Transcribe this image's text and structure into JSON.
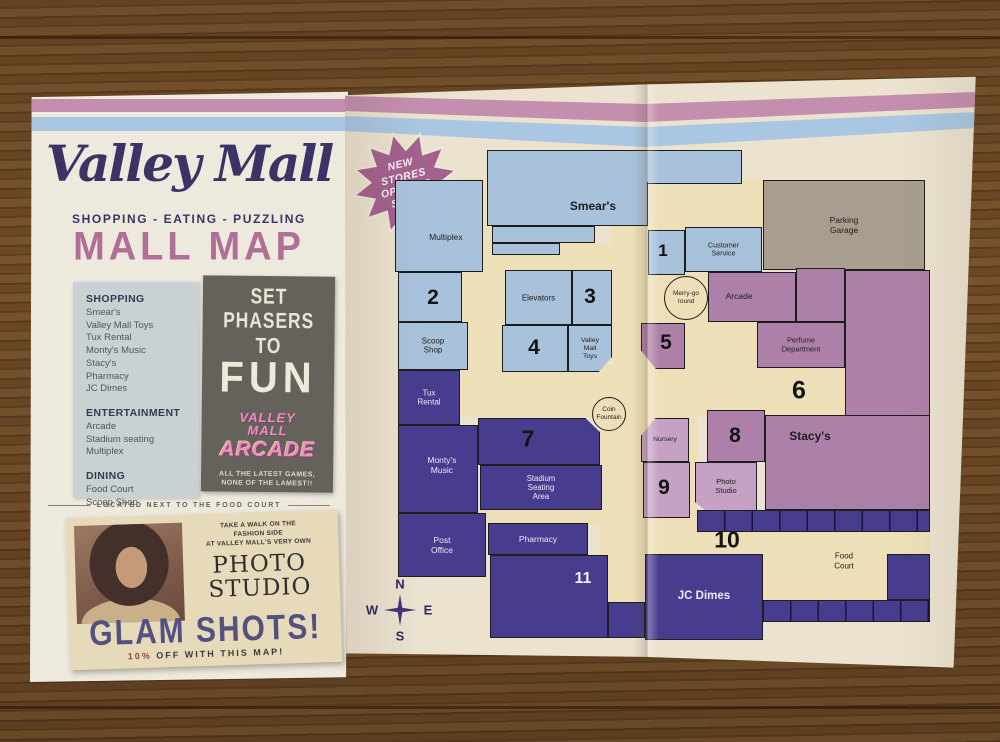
{
  "cover": {
    "logo": "Valley Mall",
    "tagline": "SHOPPING - EATING - PUZZLING",
    "title": "MALL MAP",
    "directory": [
      {
        "heading": "SHOPPING",
        "items": [
          "Smear's",
          "Valley Mall Toys",
          "Tux Rental",
          "Monty's Music",
          "Stacy's",
          "Pharmacy",
          "JC Dimes"
        ]
      },
      {
        "heading": "ENTERTAINMENT",
        "items": [
          "Arcade",
          "Stadium seating",
          "Multiplex"
        ]
      },
      {
        "heading": "DINING",
        "items": [
          "Food Court",
          "Scoop Shop"
        ]
      }
    ],
    "arcade_ad": {
      "headline": "SET\nPHASERS\nTO",
      "big_word": "FUN",
      "logo_top": "VALLEY\nMALL",
      "logo_main": "ARCADE",
      "tagline": "ALL THE LATEST GAMES,\nNONE OF THE LAMEST!!"
    },
    "kicker": "LOCATED NEXT TO THE FOOD COURT",
    "photo_ad": {
      "lead": "TAKE A WALK ON THE\nFASHION SIDE\nAT VALLEY MALL'S VERY OWN",
      "title": "PHOTO\nSTUDIO",
      "headline": "GLAM SHOTS!",
      "offer_prefix": "10%",
      "offer_rest": " OFF WITH THIS MAP!"
    }
  },
  "map": {
    "badge": "NEW\nSTORES\nOPENING\nSOON!",
    "compass": {
      "n": "N",
      "s": "S",
      "e": "E",
      "w": "W"
    },
    "halls": [
      {
        "id": "hall-west",
        "x": 110,
        "y": 90,
        "w": 45,
        "h": 196
      },
      {
        "id": "hall-smears-south",
        "x": 142,
        "y": 155,
        "w": 120,
        "h": 27
      },
      {
        "id": "hall-central",
        "x": 105,
        "y": 277,
        "w": 395,
        "h": 52
      },
      {
        "id": "hall-carousel",
        "x": 262,
        "y": 124,
        "w": 100,
        "h": 160
      },
      {
        "id": "hall-northeast",
        "x": 300,
        "y": 92,
        "w": 115,
        "h": 47
      },
      {
        "id": "hall-southeast",
        "x": 250,
        "y": 327,
        "w": 97,
        "h": 192
      },
      {
        "id": "hall-ten",
        "x": 252,
        "y": 444,
        "w": 328,
        "h": 26
      },
      {
        "id": "hall-food-court",
        "x": 413,
        "y": 466,
        "w": 124,
        "h": 46
      },
      {
        "id": "hall-stadium-south",
        "x": 130,
        "y": 420,
        "w": 122,
        "h": 17
      },
      {
        "id": "hall-perfume-west",
        "x": 335,
        "y": 232,
        "w": 75,
        "h": 50
      }
    ],
    "rooms": [
      {
        "id": "multiplex",
        "c": "blue",
        "x": 45,
        "y": 92,
        "w": 88,
        "h": 92,
        "l": "Multiplex",
        "fs": 8.5,
        "lp": [
          58,
          62
        ]
      },
      {
        "id": "room-2",
        "c": "blue",
        "x": 48,
        "y": 184,
        "w": 64,
        "h": 50
      },
      {
        "id": "scoop-shop",
        "c": "blue",
        "x": 48,
        "y": 234,
        "w": 70,
        "h": 48,
        "l": "Scoop\nShop",
        "fs": 8
      },
      {
        "id": "smears-upper",
        "c": "blue",
        "x": 137,
        "y": 62,
        "w": 255,
        "h": 34
      },
      {
        "id": "smears",
        "c": "blue",
        "x": 137,
        "y": 94,
        "w": 161,
        "h": 44,
        "l": "Smear's",
        "b": 1,
        "fs": 12,
        "lp": [
          66,
          55
        ],
        "noTop": 1
      },
      {
        "id": "smears-annex-a",
        "c": "blue",
        "x": 142,
        "y": 138,
        "w": 103,
        "h": 17
      },
      {
        "id": "smears-annex-b",
        "c": "blue",
        "x": 142,
        "y": 155,
        "w": 68,
        "h": 12
      },
      {
        "id": "elevators",
        "c": "blue",
        "x": 155,
        "y": 182,
        "w": 67,
        "h": 55,
        "l": "Elevators",
        "fs": 8
      },
      {
        "id": "room-3",
        "c": "blue",
        "x": 222,
        "y": 182,
        "w": 40,
        "h": 55
      },
      {
        "id": "room-4",
        "c": "blue",
        "x": 152,
        "y": 237,
        "w": 66,
        "h": 47
      },
      {
        "id": "valley-mall-toys",
        "c": "blue",
        "x": 218,
        "y": 237,
        "w": 44,
        "h": 47,
        "l": "Valley\nMall\nToys",
        "fs": 6.8,
        "clip": "br"
      },
      {
        "id": "room-1",
        "c": "blue",
        "x": 298,
        "y": 142,
        "w": 37,
        "h": 45
      },
      {
        "id": "customer-service",
        "c": "blue",
        "x": 335,
        "y": 139,
        "w": 77,
        "h": 45,
        "l": "Customer\nService",
        "fs": 7.2
      },
      {
        "id": "parking-garage",
        "c": "gray",
        "x": 413,
        "y": 92,
        "w": 162,
        "h": 90,
        "l": "Parking\nGarage",
        "fs": 8.5
      },
      {
        "id": "arcade",
        "c": "mauve",
        "x": 358,
        "y": 184,
        "w": 88,
        "h": 50,
        "l": "Arcade",
        "fs": 8.5,
        "lp": [
          35,
          48
        ]
      },
      {
        "id": "arcade-annex",
        "c": "mauve",
        "x": 446,
        "y": 180,
        "w": 49,
        "h": 54
      },
      {
        "id": "perfume-department",
        "c": "mauve",
        "x": 407,
        "y": 234,
        "w": 88,
        "h": 46,
        "l": "Perfume\nDepartment",
        "fs": 7.4
      },
      {
        "id": "room-5",
        "c": "mauve",
        "x": 291,
        "y": 235,
        "w": 44,
        "h": 46,
        "clip": "bl"
      },
      {
        "id": "stacys-main",
        "c": "mauve",
        "x": 495,
        "y": 182,
        "w": 85,
        "h": 240
      },
      {
        "id": "stacys",
        "c": "mauve",
        "x": 415,
        "y": 327,
        "w": 165,
        "h": 95,
        "l": "Stacy's",
        "b": 1,
        "fs": 12,
        "lp": [
          27,
          22
        ]
      },
      {
        "id": "room-8",
        "c": "mauve",
        "x": 357,
        "y": 322,
        "w": 58,
        "h": 52
      },
      {
        "id": "nursery",
        "c": "lilac",
        "x": 291,
        "y": 330,
        "w": 48,
        "h": 44,
        "l": "Nursery",
        "fs": 6.8,
        "clip": "tl"
      },
      {
        "id": "room-9",
        "c": "lilac",
        "x": 293,
        "y": 374,
        "w": 47,
        "h": 56
      },
      {
        "id": "photo-studio",
        "c": "lilac",
        "x": 345,
        "y": 374,
        "w": 62,
        "h": 50,
        "l": "Photo\nStudio",
        "fs": 7.5,
        "clip": "bl2"
      },
      {
        "id": "tux-rental",
        "c": "purple",
        "x": 48,
        "y": 282,
        "w": 62,
        "h": 55,
        "l": "Tux\nRental",
        "fs": 8
      },
      {
        "id": "montys-music",
        "c": "purple",
        "x": 48,
        "y": 337,
        "w": 80,
        "h": 88,
        "l": "Monty's\nMusic",
        "fs": 8.5,
        "lp": [
          55,
          45
        ]
      },
      {
        "id": "room-7",
        "c": "purple",
        "x": 128,
        "y": 330,
        "w": 122,
        "h": 47,
        "clip": "tr"
      },
      {
        "id": "stadium-seating",
        "c": "purple",
        "x": 130,
        "y": 377,
        "w": 122,
        "h": 45,
        "l": "Stadium\nSeating\nArea",
        "fs": 7.8
      },
      {
        "id": "post-office",
        "c": "purple",
        "x": 48,
        "y": 425,
        "w": 88,
        "h": 64,
        "l": "Post\nOffice",
        "fs": 8.5
      },
      {
        "id": "pharmacy",
        "c": "purple",
        "x": 138,
        "y": 435,
        "w": 100,
        "h": 32,
        "l": "Pharmacy",
        "fs": 8.5
      },
      {
        "id": "room-11-block",
        "c": "purple",
        "x": 140,
        "y": 467,
        "w": 118,
        "h": 83
      },
      {
        "id": "south-wing",
        "c": "purple",
        "x": 258,
        "y": 514,
        "w": 37,
        "h": 36
      },
      {
        "id": "jc-dimes",
        "c": "purple",
        "x": 295,
        "y": 466,
        "w": 118,
        "h": 86,
        "l": "JC Dimes",
        "b": 1,
        "fs": 11.5
      },
      {
        "id": "food-stalls-north",
        "c": "purple",
        "x": 347,
        "y": 422,
        "w": 233,
        "h": 22,
        "pat": 1
      },
      {
        "id": "food-stalls-east",
        "c": "purple",
        "x": 537,
        "y": 466,
        "w": 43,
        "h": 46
      },
      {
        "id": "food-stalls-south",
        "c": "purple",
        "x": 413,
        "y": 512,
        "w": 167,
        "h": 22,
        "pat": 1
      }
    ],
    "numbers": [
      {
        "n": "1",
        "x": 313,
        "y": 163,
        "s": 17
      },
      {
        "n": "2",
        "x": 83,
        "y": 210,
        "s": 21
      },
      {
        "n": "3",
        "x": 240,
        "y": 209,
        "s": 21
      },
      {
        "n": "4",
        "x": 184,
        "y": 260,
        "s": 21
      },
      {
        "n": "5",
        "x": 316,
        "y": 255,
        "s": 21
      },
      {
        "n": "6",
        "x": 449,
        "y": 303,
        "s": 25
      },
      {
        "n": "7",
        "x": 178,
        "y": 351,
        "s": 23
      },
      {
        "n": "8",
        "x": 385,
        "y": 348,
        "s": 21
      },
      {
        "n": "9",
        "x": 314,
        "y": 400,
        "s": 21
      },
      {
        "n": "10",
        "x": 377,
        "y": 452,
        "s": 23
      },
      {
        "n": "11",
        "x": 233,
        "y": 491,
        "s": 16,
        "w": 1
      }
    ],
    "circles": [
      {
        "id": "merry-go-round",
        "l": "Merry-go\nround",
        "cx": 336,
        "cy": 210,
        "r": 22,
        "fs": 6.5
      },
      {
        "id": "coin-fountain",
        "l": "Coin\nFountain",
        "cx": 259,
        "cy": 326,
        "r": 17,
        "fs": 6.5
      }
    ],
    "labels": [
      {
        "id": "food-court",
        "t": "Food\nCourt",
        "x": 494,
        "y": 473,
        "fs": 8
      }
    ]
  },
  "colors": {
    "paper_cover": "#eee9dd",
    "paper_map": "#ebe2cf",
    "stripe_pink": "#c48fae",
    "stripe_blue": "#a9c7e2",
    "navy": "#3b3366",
    "title_pink": "#b06f97",
    "map_blue": "#a9c2dc",
    "map_purple": "#483c8e",
    "map_mauve": "#ad80a9",
    "map_lilac": "#c5a2c5",
    "map_gray": "#a89d8e",
    "map_hall": "#eddfb7",
    "badge": "#a4618e",
    "wood": "#6b4726"
  }
}
